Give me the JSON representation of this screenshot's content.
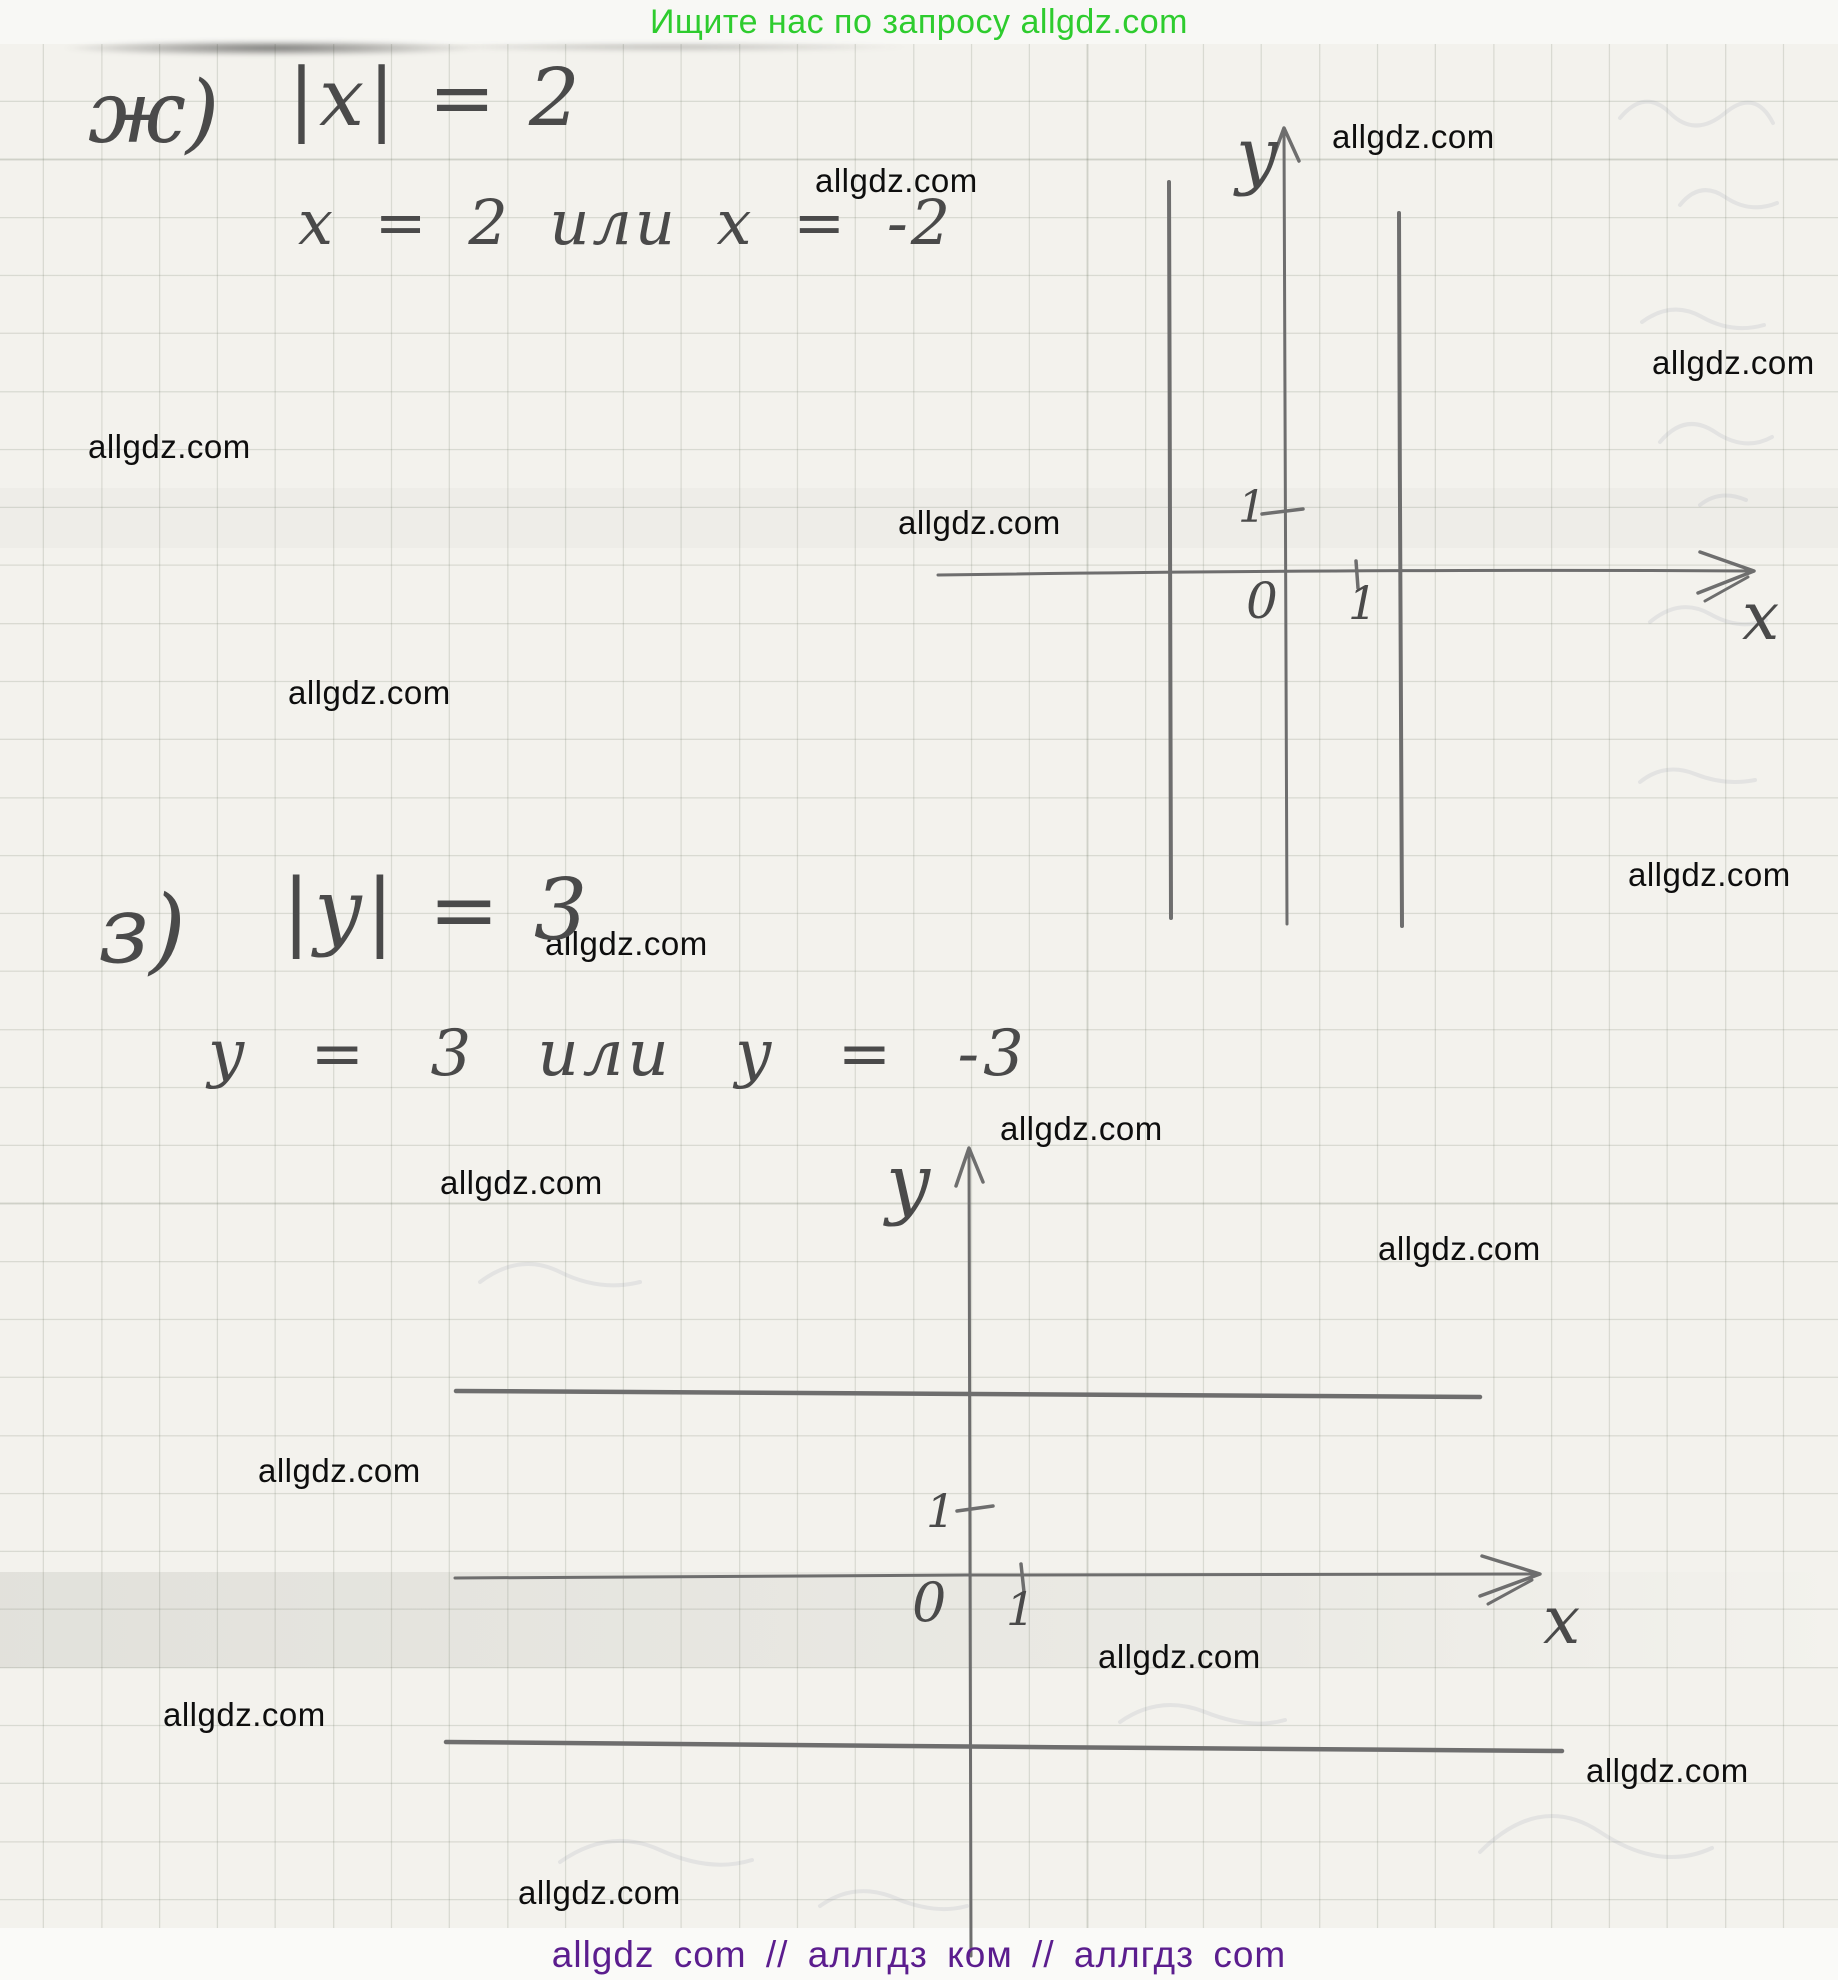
{
  "header": {
    "text": "Ищите нас по запросу allgdz.com",
    "color": "#2ecc2e"
  },
  "footer": {
    "text": "allgdz com // аллгдз ком // аллгдз com",
    "color": "#5b1d8e"
  },
  "watermark": {
    "text": "allgdz.com",
    "color": "#0e0e0e",
    "positions": [
      {
        "x": 1332,
        "y": 118
      },
      {
        "x": 815,
        "y": 162
      },
      {
        "x": 1652,
        "y": 344
      },
      {
        "x": 88,
        "y": 428
      },
      {
        "x": 898,
        "y": 504
      },
      {
        "x": 288,
        "y": 674
      },
      {
        "x": 1628,
        "y": 856
      },
      {
        "x": 545,
        "y": 925
      },
      {
        "x": 1000,
        "y": 1110
      },
      {
        "x": 440,
        "y": 1164
      },
      {
        "x": 1378,
        "y": 1230
      },
      {
        "x": 258,
        "y": 1452
      },
      {
        "x": 1098,
        "y": 1638
      },
      {
        "x": 163,
        "y": 1696
      },
      {
        "x": 1586,
        "y": 1752
      },
      {
        "x": 518,
        "y": 1874
      }
    ]
  },
  "problems": [
    {
      "label": "ж)",
      "equation": "|x| = 2",
      "solution": "x = 2 или x = -2",
      "plane": {
        "y_label": "y",
        "x_label": "x",
        "origin_label": "0",
        "x_tick_label": "1",
        "y_tick_label": "1",
        "drawn_lines": [
          "вертикальная прямая x = 2",
          "вертикальная прямая x = -2"
        ]
      }
    },
    {
      "label": "з)",
      "equation": "|y| = 3",
      "solution": "y = 3 или y = -3",
      "plane": {
        "y_label": "y",
        "x_label": "x",
        "origin_label": "0",
        "x_tick_label": "1",
        "y_tick_label": "1",
        "drawn_lines": [
          "горизонтальная прямая y = 3",
          "горизонтальная прямая y = -3"
        ]
      }
    }
  ]
}
